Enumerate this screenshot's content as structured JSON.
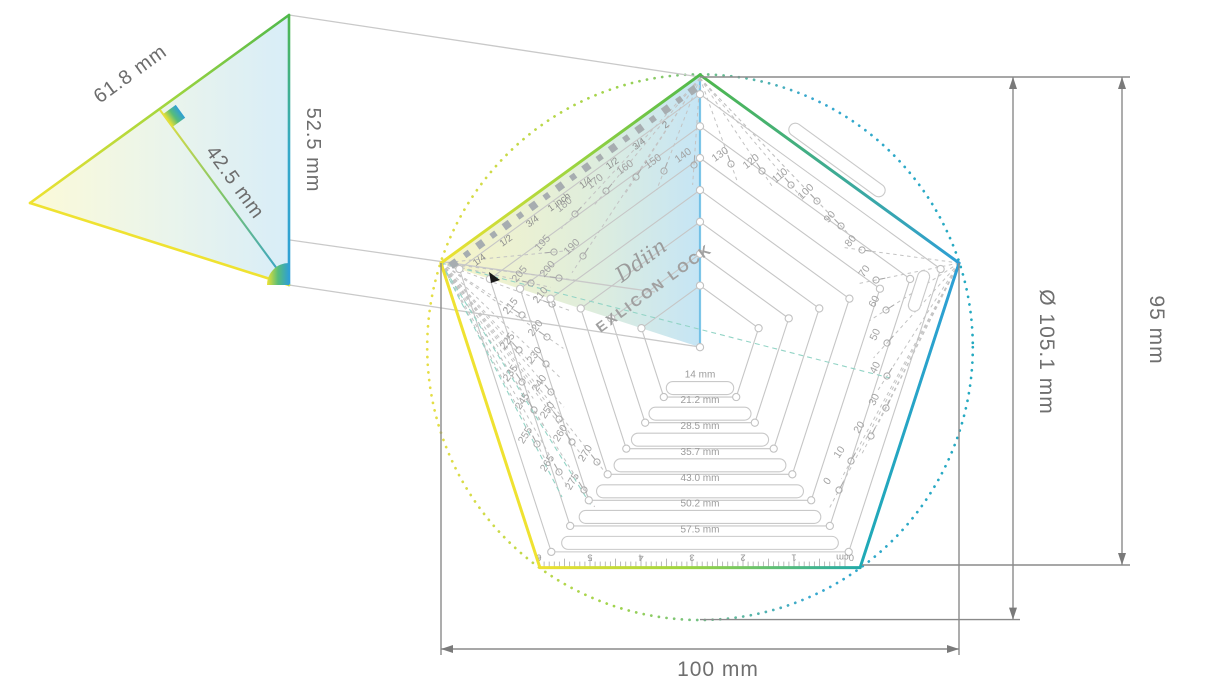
{
  "brand": {
    "logo": "Ddiin",
    "product": "EXLICON LOCK"
  },
  "detail_triangle": {
    "side_label": "61.8 mm",
    "radius_label": "42.5 mm",
    "height_label": "52.5 mm"
  },
  "dimensions": {
    "circle_diameter": "Ø 105.1 mm",
    "pentagon_height": "95 mm",
    "pentagon_width": "100 mm"
  },
  "ring_size_labels": [
    "14 mm",
    "21.2 mm",
    "28.5 mm",
    "35.7 mm",
    "43.0 mm",
    "50.2 mm",
    "57.5 mm"
  ],
  "inch_ruler_labels": [
    "1/4",
    "1/2",
    "3/4",
    "1 inch",
    "1/4",
    "1/2",
    "3/4",
    "2"
  ],
  "cm_ruler_labels": [
    "6",
    "5",
    "4",
    "3",
    "2",
    "1",
    "0cm"
  ],
  "angle_numbers_left": [
    "140",
    "150",
    "160",
    "170",
    "180",
    "190",
    "195",
    "200",
    "205",
    "210",
    "215",
    "220",
    "225",
    "230",
    "235",
    "240",
    "245",
    "250",
    "255",
    "260",
    "265",
    "270",
    "275"
  ],
  "angle_numbers_right": [
    "130",
    "120",
    "110",
    "100",
    "90",
    "80",
    "70",
    "60",
    "50",
    "40",
    "30",
    "20",
    "10",
    "0"
  ],
  "colors": {
    "yellow": "#efe231",
    "yellow_green": "#9ed53f",
    "green": "#4fb84b",
    "blue": "#2e9fd6",
    "teal": "#1faab5",
    "ring_gray": "#c6c6c6",
    "number_gray": "#a2a2a2",
    "dimension_gray": "#7a7a7a",
    "projection_gray": "#c9c9c9"
  }
}
